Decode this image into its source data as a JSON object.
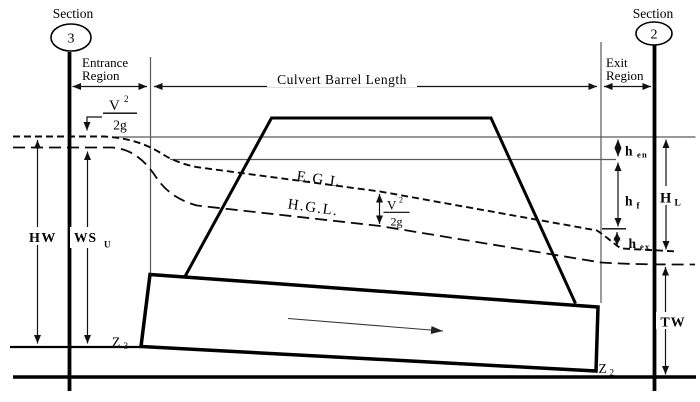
{
  "figure": {
    "sections": {
      "left": {
        "label": "Section",
        "number": "3"
      },
      "right": {
        "label": "Section",
        "number": "2"
      }
    },
    "regions": {
      "entrance_line1": "Entrance",
      "entrance_line2": "Region",
      "barrel_length": "Culvert Barrel Length",
      "exit_line1": "Exit",
      "exit_line2": "Region"
    },
    "grade_lines": {
      "energy": "E.G.L.",
      "hydraulic": "H.G.L."
    },
    "velocity_head": {
      "symbol": "V",
      "exponent": "2",
      "denominator": "2g"
    },
    "measurements": {
      "headwater": "HW",
      "upstream_water_surface": "WS",
      "upstream_water_surface_sub": "U",
      "entrance_loss": "h",
      "entrance_loss_sub": "en",
      "friction_loss": "h",
      "friction_loss_sub": "f",
      "exit_loss": "h",
      "exit_loss_sub": "ex",
      "total_head_loss": "H",
      "total_head_loss_sub": "L",
      "tailwater": "TW",
      "upstream_invert": "Z",
      "upstream_invert_sub": "3",
      "downstream_invert": "Z",
      "downstream_invert_sub": "2"
    },
    "colors": {
      "ink": "#000000",
      "thin_line": "#5a5a5a",
      "background": "#ffffff"
    }
  }
}
